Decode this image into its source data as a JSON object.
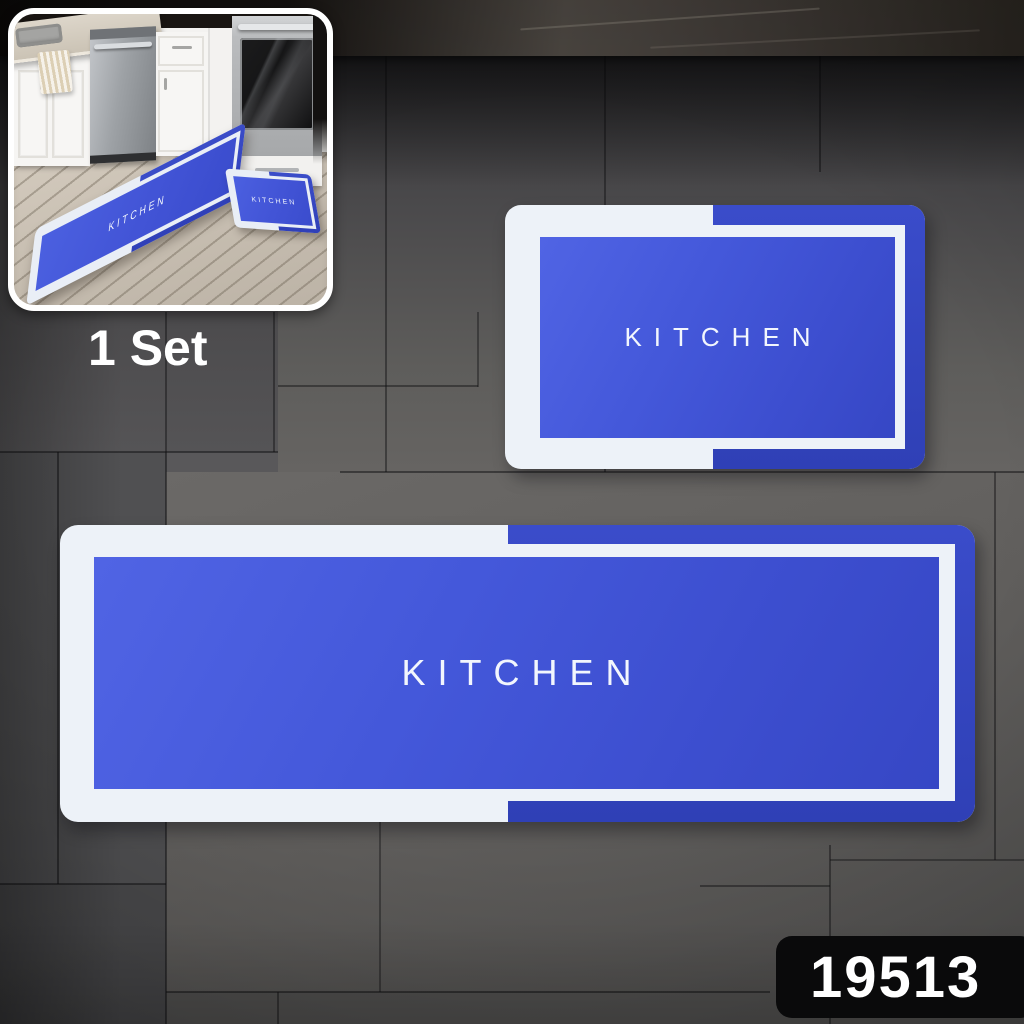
{
  "scene": {
    "set_label": "1 Set",
    "sku": "19513"
  },
  "mats": {
    "small": {
      "label": "KITCHEN"
    },
    "large": {
      "label": "KITCHEN"
    }
  },
  "inset": {
    "runner_label": "KITCHEN",
    "mat_label": "KITCHEN"
  },
  "colors": {
    "mat_blue": "#4154d6",
    "mat_edge_blue": "#3243bf",
    "mat_border_white": "#edf2f8",
    "mat_text": "#f2f6fd",
    "badge_bg": "#0a0a0b",
    "badge_text": "#ffffff",
    "set_label_text": "#ffffff",
    "tile_gray": "#5b5a5c",
    "counter_band_dark": "#2b2724"
  }
}
